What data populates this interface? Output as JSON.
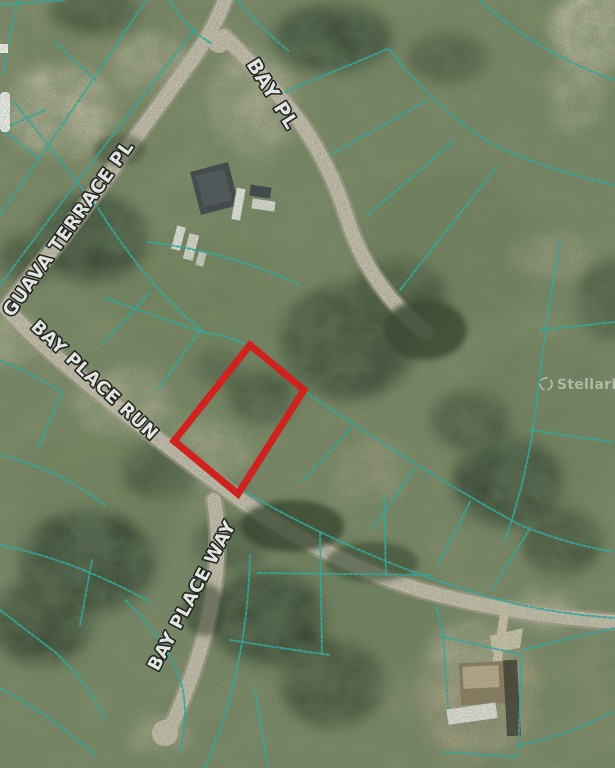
{
  "map": {
    "type": "aerial-parcel-map",
    "street_labels": [
      {
        "name": "BAY PL"
      },
      {
        "name": "GUAVA TERRACE PL"
      },
      {
        "name": "BAY PLACE RUN"
      },
      {
        "name": "BAY PLACE WAY"
      }
    ],
    "highlight": {
      "color": "#e81414",
      "description": "subject lot outline"
    },
    "parcel_line_color": "#2fb3a8",
    "road_color": "#c9c2b1",
    "watermark": {
      "text": "StellarMLS"
    }
  }
}
